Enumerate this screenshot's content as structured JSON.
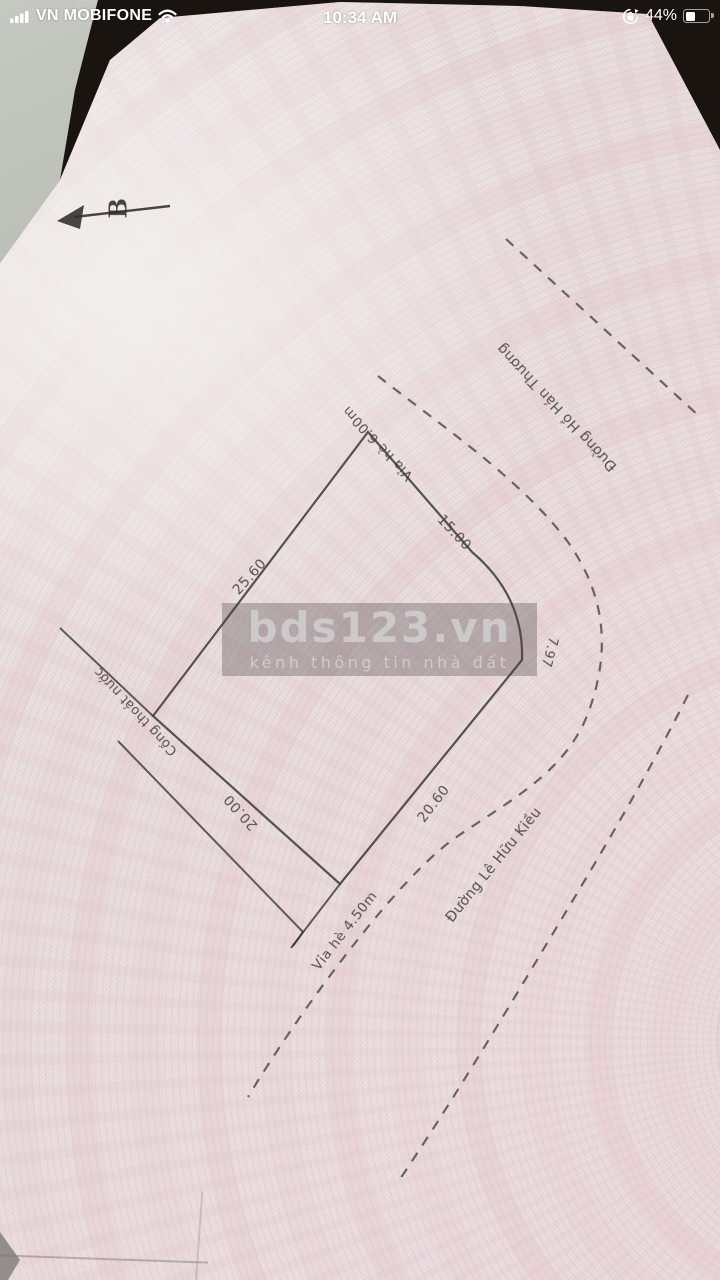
{
  "status_bar": {
    "carrier": "VN MOBIFONE",
    "time": "10:34 AM",
    "battery_percent": "44%",
    "icons": {
      "signal": "signal-bars-icon",
      "wifi": "wifi-icon",
      "rotation_lock": "rotation-lock-icon",
      "battery": "battery-icon"
    }
  },
  "photo": {
    "compass_label": "B",
    "certificate_edge_text": "khác gắn liền với đất",
    "watermark": {
      "title": "bds123.vn",
      "subtitle": "kênh thông tin nhà đất"
    },
    "plot": {
      "dimensions": {
        "top_left": "25.60",
        "top_right": "15.00",
        "corner_arc": "7.97",
        "bottom_right": "20.60",
        "bottom_left": "20.00"
      },
      "labels": {
        "sidewalk_top": "Vỉa hè 6.00m",
        "drain": "Cống thoát nước",
        "sidewalk_bottom": "Vỉa hè 4.50m",
        "road_bottom": "Đường Lê Hữu Kiều",
        "road_top": "Đường Hồ Hán Thương"
      }
    },
    "colors": {
      "paper": "#eae1e0",
      "pattern_pink": "#e6c9ce",
      "line": "#3c3937",
      "watermark_band": "#a7a1a3"
    }
  }
}
